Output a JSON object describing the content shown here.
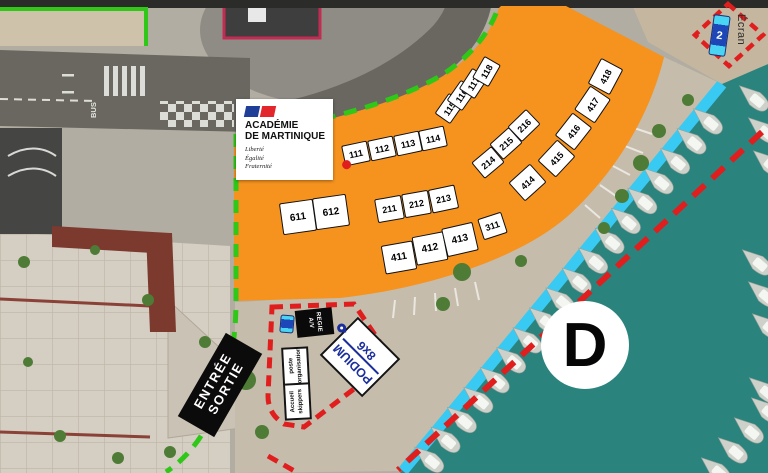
{
  "colors": {
    "orange": "#F6921E",
    "green": "#2FC718",
    "red": "#E01E1E",
    "cyan": "#38CAF2",
    "water": "#2B837E",
    "navy": "#1B2E9B"
  },
  "logo": {
    "title1": "ACADÉMIE",
    "title2": "DE MARTINIQUE",
    "motto1": "Liberté",
    "motto2": "Égalité",
    "motto3": "Fraternité"
  },
  "zone_d": {
    "label": "D"
  },
  "entrance": {
    "line1": "ENTRÉE",
    "line2": "SORTIE"
  },
  "podium": {
    "line1": "PODIUM",
    "line2": "8x6"
  },
  "regie": {
    "line1": "REGIE",
    "line2": "A/V"
  },
  "poste": {
    "line1": "poste",
    "line2": "organisation"
  },
  "accueil": {
    "line1": "Accueil",
    "line2": "skippers"
  },
  "ecran": {
    "number": "2",
    "label": "Écran"
  },
  "road": {
    "bus": "BUS"
  },
  "booths": [
    {
      "label": "111",
      "x": 356,
      "y": 153,
      "w": 26,
      "h": 21,
      "r": -12,
      "fs": 9,
      "dot": true
    },
    {
      "label": "112",
      "x": 382,
      "y": 148,
      "w": 26,
      "h": 21,
      "r": -12,
      "fs": 9
    },
    {
      "label": "113",
      "x": 408,
      "y": 143,
      "w": 26,
      "h": 21,
      "r": -12,
      "fs": 9
    },
    {
      "label": "114",
      "x": 433,
      "y": 138,
      "w": 26,
      "h": 21,
      "r": -12,
      "fs": 9
    },
    {
      "label": "115",
      "x": 449,
      "y": 108,
      "w": 25,
      "h": 19,
      "r": -55,
      "fs": 9
    },
    {
      "label": "116",
      "x": 461,
      "y": 95,
      "w": 25,
      "h": 19,
      "r": -55,
      "fs": 9
    },
    {
      "label": "117",
      "x": 473,
      "y": 83,
      "w": 25,
      "h": 19,
      "r": -57,
      "fs": 9
    },
    {
      "label": "118",
      "x": 486,
      "y": 71,
      "w": 25,
      "h": 19,
      "r": -60,
      "fs": 9
    },
    {
      "label": "214",
      "x": 488,
      "y": 162,
      "w": 26,
      "h": 21,
      "r": -40,
      "fs": 9
    },
    {
      "label": "215",
      "x": 506,
      "y": 143,
      "w": 26,
      "h": 21,
      "r": -42,
      "fs": 9
    },
    {
      "label": "216",
      "x": 524,
      "y": 125,
      "w": 26,
      "h": 21,
      "r": -44,
      "fs": 9
    },
    {
      "label": "414",
      "x": 527,
      "y": 182,
      "w": 29,
      "h": 25,
      "r": -42,
      "fs": 9
    },
    {
      "label": "415",
      "x": 556,
      "y": 158,
      "w": 29,
      "h": 25,
      "r": -47,
      "fs": 9
    },
    {
      "label": "416",
      "x": 573,
      "y": 131,
      "w": 29,
      "h": 25,
      "r": -52,
      "fs": 9
    },
    {
      "label": "417",
      "x": 592,
      "y": 104,
      "w": 29,
      "h": 25,
      "r": -56,
      "fs": 9
    },
    {
      "label": "418",
      "x": 605,
      "y": 76,
      "w": 29,
      "h": 25,
      "r": -62,
      "fs": 9
    },
    {
      "label": "211",
      "x": 389,
      "y": 209,
      "w": 27,
      "h": 24,
      "r": -10,
      "fs": 9
    },
    {
      "label": "212",
      "x": 416,
      "y": 204,
      "w": 27,
      "h": 24,
      "r": -10,
      "fs": 9
    },
    {
      "label": "213",
      "x": 443,
      "y": 199,
      "w": 27,
      "h": 24,
      "r": -12,
      "fs": 9
    },
    {
      "label": "411",
      "x": 399,
      "y": 257,
      "w": 32,
      "h": 29,
      "r": -10,
      "fs": 10
    },
    {
      "label": "412",
      "x": 430,
      "y": 248,
      "w": 32,
      "h": 29,
      "r": -11,
      "fs": 10
    },
    {
      "label": "413",
      "x": 460,
      "y": 239,
      "w": 32,
      "h": 29,
      "r": -13,
      "fs": 10
    },
    {
      "label": "311",
      "x": 492,
      "y": 226,
      "w": 25,
      "h": 22,
      "r": -18,
      "fs": 9
    },
    {
      "label": "611",
      "x": 298,
      "y": 217,
      "w": 34,
      "h": 32,
      "r": -8,
      "fs": 10
    },
    {
      "label": "612",
      "x": 331,
      "y": 212,
      "w": 34,
      "h": 32,
      "r": -8,
      "fs": 10
    }
  ]
}
